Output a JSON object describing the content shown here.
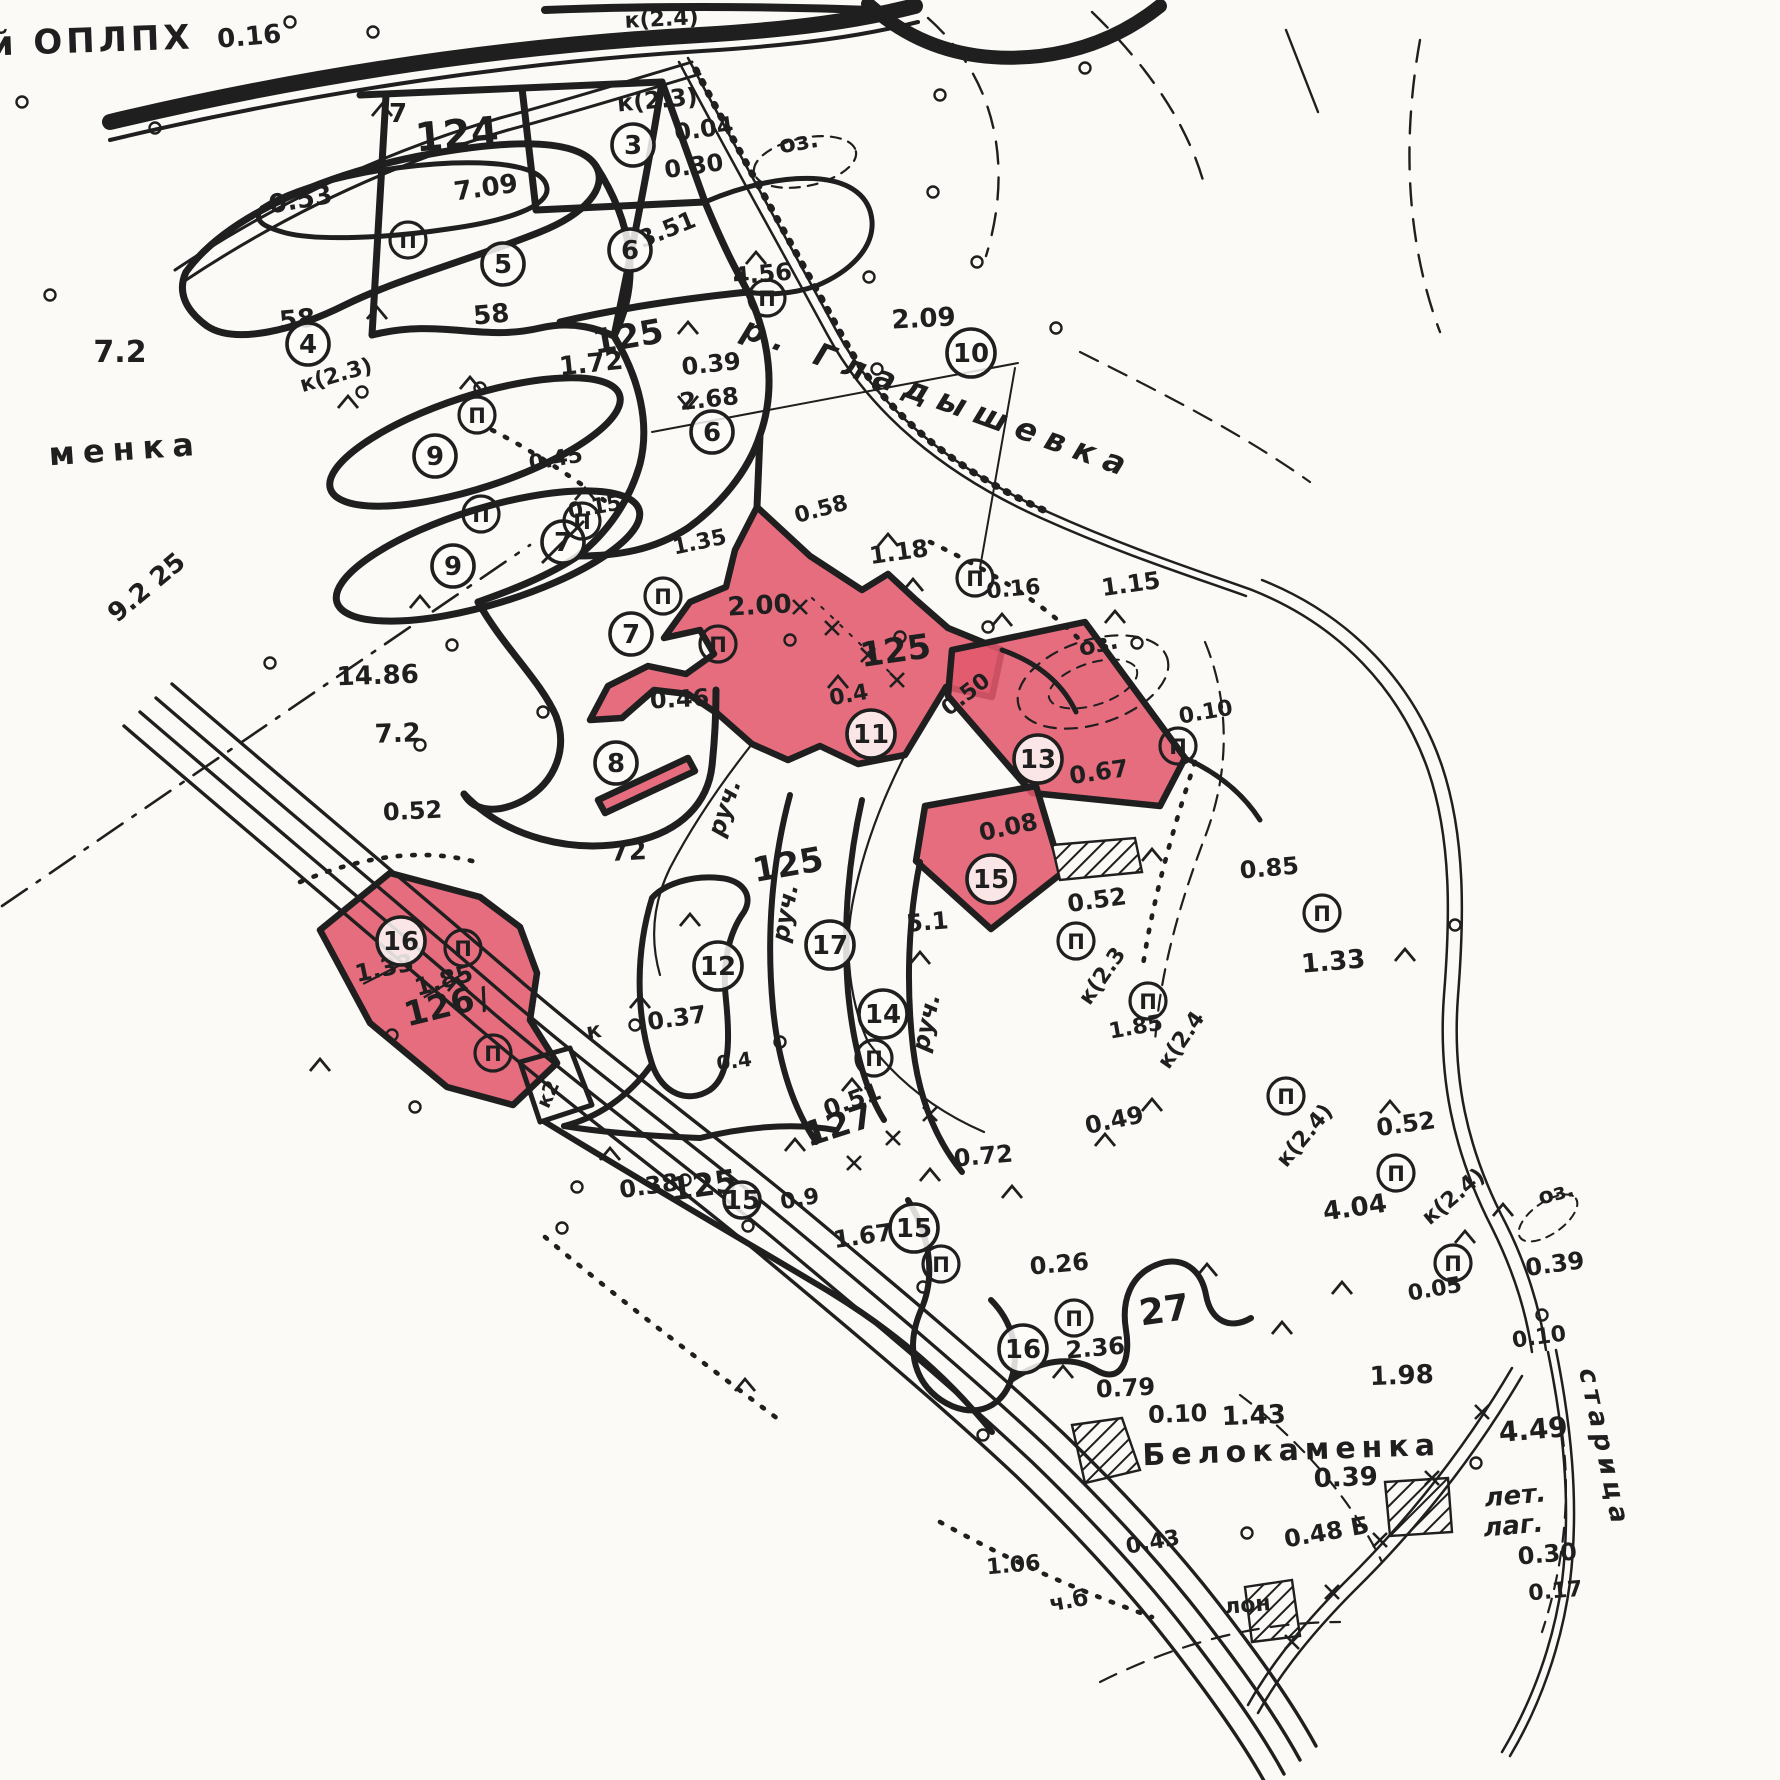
{
  "colors": {
    "paper": "#fbfaf6",
    "ink": "#1f1f1f",
    "highlight": "#e2596d"
  },
  "map": {
    "region_names": [
      "й ОПЛПХ",
      "менка",
      "р. Гладышевка",
      "Белокаменка",
      "старица",
      "лет. лаг."
    ],
    "quarter_numbers": [
      "124",
      "125",
      "126",
      "127"
    ],
    "highlighted_plot_numbers": [
      "11",
      "13",
      "15",
      "16"
    ],
    "labels": [
      {
        "t": "й ОПЛПХ",
        "x": 92,
        "y": 52,
        "s": 34,
        "r": -2,
        "ls": 4
      },
      {
        "t": "0.16",
        "x": 250,
        "y": 45,
        "s": 26,
        "r": -5
      },
      {
        "t": "к(2.4)",
        "x": 662,
        "y": 26,
        "s": 22,
        "r": -3
      },
      {
        "t": "оз.",
        "x": 800,
        "y": 150,
        "s": 24,
        "r": -10
      },
      {
        "t": "менка",
        "x": 126,
        "y": 460,
        "s": 32,
        "r": -4,
        "ls": 8
      },
      {
        "t": "7.2",
        "x": 120,
        "y": 362,
        "s": 30,
        "r": 0
      },
      {
        "t": "9.2 25",
        "x": 152,
        "y": 594,
        "s": 26,
        "r": -40
      },
      {
        "t": "0.53",
        "x": 302,
        "y": 208,
        "s": 26,
        "r": -10
      },
      {
        "t": "124",
        "x": 458,
        "y": 148,
        "s": 40,
        "r": -5
      },
      {
        "t": "7.09",
        "x": 487,
        "y": 196,
        "s": 26,
        "r": -8
      },
      {
        "t": "7",
        "x": 398,
        "y": 122,
        "s": 26,
        "r": 0
      },
      {
        "t": "58",
        "x": 298,
        "y": 328,
        "s": 26,
        "r": -5
      },
      {
        "t": "58",
        "x": 492,
        "y": 323,
        "s": 26,
        "r": -5
      },
      {
        "t": "к(2.3)",
        "x": 338,
        "y": 382,
        "s": 22,
        "r": -16
      },
      {
        "t": "к(2.3)",
        "x": 658,
        "y": 108,
        "s": 24,
        "r": -5
      },
      {
        "t": "0.04",
        "x": 705,
        "y": 137,
        "s": 24,
        "r": -8
      },
      {
        "t": "0.30",
        "x": 695,
        "y": 174,
        "s": 24,
        "r": -8
      },
      {
        "t": "3.51",
        "x": 670,
        "y": 237,
        "s": 24,
        "r": -22
      },
      {
        "t": "4.56",
        "x": 763,
        "y": 282,
        "s": 24,
        "r": -5
      },
      {
        "t": "1.72",
        "x": 592,
        "y": 372,
        "s": 26,
        "r": -6
      },
      {
        "t": "125",
        "x": 630,
        "y": 348,
        "s": 34,
        "r": -10
      },
      {
        "t": "0.39",
        "x": 712,
        "y": 372,
        "s": 24,
        "r": -6
      },
      {
        "t": "2.68",
        "x": 710,
        "y": 407,
        "s": 24,
        "r": -6
      },
      {
        "t": "2.09",
        "x": 924,
        "y": 327,
        "s": 26,
        "r": -3
      },
      {
        "t": "р. Гладышевка",
        "x": 935,
        "y": 408,
        "s": 32,
        "r": 20,
        "ls": 10,
        "i": 1
      },
      {
        "t": "1.18",
        "x": 900,
        "y": 560,
        "s": 24,
        "r": -8
      },
      {
        "t": "0.16",
        "x": 1014,
        "y": 596,
        "s": 22,
        "r": -5
      },
      {
        "t": "1.15",
        "x": 1132,
        "y": 592,
        "s": 24,
        "r": -8
      },
      {
        "t": "оз.",
        "x": 1100,
        "y": 652,
        "s": 24,
        "r": -12
      },
      {
        "t": "2.00",
        "x": 760,
        "y": 614,
        "s": 26,
        "r": -3
      },
      {
        "t": "0.46",
        "x": 680,
        "y": 707,
        "s": 24,
        "r": -3
      },
      {
        "t": "0.45",
        "x": 557,
        "y": 466,
        "s": 22,
        "r": -10
      },
      {
        "t": "0.15",
        "x": 596,
        "y": 514,
        "s": 22,
        "r": -10
      },
      {
        "t": "1.35",
        "x": 701,
        "y": 549,
        "s": 22,
        "r": -12
      },
      {
        "t": "0.58",
        "x": 823,
        "y": 516,
        "s": 22,
        "r": -15
      },
      {
        "t": "14.86",
        "x": 378,
        "y": 684,
        "s": 26,
        "r": -2
      },
      {
        "t": "7.2",
        "x": 398,
        "y": 742,
        "s": 26,
        "r": -2
      },
      {
        "t": "0.52",
        "x": 413,
        "y": 819,
        "s": 24,
        "r": -3
      },
      {
        "t": "72",
        "x": 629,
        "y": 860,
        "s": 26,
        "r": -3
      },
      {
        "t": "0.4",
        "x": 850,
        "y": 702,
        "s": 22,
        "r": -10
      },
      {
        "t": "125",
        "x": 897,
        "y": 662,
        "s": 34,
        "r": -8
      },
      {
        "t": "0.50",
        "x": 970,
        "y": 700,
        "s": 22,
        "r": -38
      },
      {
        "t": "0.67",
        "x": 1100,
        "y": 780,
        "s": 24,
        "r": -8
      },
      {
        "t": "0.08",
        "x": 1010,
        "y": 835,
        "s": 24,
        "r": -12
      },
      {
        "t": "5.1",
        "x": 928,
        "y": 930,
        "s": 24,
        "r": -5
      },
      {
        "t": "0.52",
        "x": 1098,
        "y": 908,
        "s": 24,
        "r": -8
      },
      {
        "t": "к(2.3",
        "x": 1108,
        "y": 980,
        "s": 22,
        "r": -55
      },
      {
        "t": "1.85",
        "x": 1137,
        "y": 1034,
        "s": 22,
        "r": -10
      },
      {
        "t": "к(2.4",
        "x": 1187,
        "y": 1044,
        "s": 22,
        "r": -55
      },
      {
        "t": "0.85",
        "x": 1270,
        "y": 876,
        "s": 24,
        "r": -5
      },
      {
        "t": "1.33",
        "x": 1334,
        "y": 970,
        "s": 26,
        "r": -5
      },
      {
        "t": "0.10",
        "x": 1207,
        "y": 719,
        "s": 22,
        "r": -10
      },
      {
        "t": "125",
        "x": 790,
        "y": 876,
        "s": 34,
        "r": -10
      },
      {
        "t": "0.37",
        "x": 678,
        "y": 1026,
        "s": 24,
        "r": -8
      },
      {
        "t": "руч.",
        "x": 732,
        "y": 810,
        "s": 24,
        "r": -72,
        "i": 1
      },
      {
        "t": "руч.",
        "x": 793,
        "y": 914,
        "s": 24,
        "r": -80,
        "i": 1
      },
      {
        "t": "руч.",
        "x": 934,
        "y": 1024,
        "s": 24,
        "r": -78,
        "i": 1
      },
      {
        "t": "к",
        "x": 595,
        "y": 1038,
        "s": 22,
        "r": -10
      },
      {
        "t": "к2",
        "x": 554,
        "y": 1097,
        "s": 20,
        "r": -65
      },
      {
        "t": "0.51",
        "x": 855,
        "y": 1108,
        "s": 24,
        "r": -20
      },
      {
        "t": "127",
        "x": 842,
        "y": 1136,
        "s": 34,
        "r": -18
      },
      {
        "t": "0.72",
        "x": 984,
        "y": 1164,
        "s": 24,
        "r": -5
      },
      {
        "t": "0.9",
        "x": 801,
        "y": 1206,
        "s": 22,
        "r": -10
      },
      {
        "t": "0.38",
        "x": 650,
        "y": 1194,
        "s": 24,
        "r": -8
      },
      {
        "t": "125",
        "x": 705,
        "y": 1196,
        "s": 32,
        "r": -8
      },
      {
        "t": "1.67",
        "x": 864,
        "y": 1244,
        "s": 24,
        "r": -8
      },
      {
        "t": "0.26",
        "x": 1060,
        "y": 1272,
        "s": 24,
        "r": -5
      },
      {
        "t": "2.36",
        "x": 1096,
        "y": 1356,
        "s": 24,
        "r": -5
      },
      {
        "t": "27",
        "x": 1166,
        "y": 1322,
        "s": 36,
        "r": -8
      },
      {
        "t": "0.49",
        "x": 1116,
        "y": 1128,
        "s": 24,
        "r": -12
      },
      {
        "t": "0.52",
        "x": 1407,
        "y": 1132,
        "s": 24,
        "r": -8
      },
      {
        "t": "4.04",
        "x": 1356,
        "y": 1216,
        "s": 26,
        "r": -8
      },
      {
        "t": "к(2.4)",
        "x": 1310,
        "y": 1140,
        "s": 22,
        "r": -50
      },
      {
        "t": "к(2.4)",
        "x": 1458,
        "y": 1202,
        "s": 22,
        "r": -40
      },
      {
        "t": "0.05",
        "x": 1436,
        "y": 1296,
        "s": 22,
        "r": -10
      },
      {
        "t": "0.39",
        "x": 1556,
        "y": 1272,
        "s": 24,
        "r": -8
      },
      {
        "t": "оз.",
        "x": 1558,
        "y": 1200,
        "s": 22,
        "r": -15
      },
      {
        "t": "0.79",
        "x": 1126,
        "y": 1396,
        "s": 24,
        "r": -3
      },
      {
        "t": "0.10",
        "x": 1178,
        "y": 1422,
        "s": 24,
        "r": -2
      },
      {
        "t": "1.43",
        "x": 1254,
        "y": 1424,
        "s": 26,
        "r": -2
      },
      {
        "t": "1.98",
        "x": 1402,
        "y": 1384,
        "s": 26,
        "r": -2
      },
      {
        "t": "Белокаменка",
        "x": 1292,
        "y": 1460,
        "s": 30,
        "r": -2,
        "ls": 6
      },
      {
        "t": "0.39",
        "x": 1346,
        "y": 1486,
        "s": 26,
        "r": -2
      },
      {
        "t": "4.49",
        "x": 1534,
        "y": 1439,
        "s": 28,
        "r": -5
      },
      {
        "t": "лет.",
        "x": 1516,
        "y": 1504,
        "s": 26,
        "r": -5,
        "i": 1
      },
      {
        "t": "лаг.",
        "x": 1514,
        "y": 1534,
        "s": 26,
        "r": -5,
        "i": 1
      },
      {
        "t": "старица",
        "x": 1596,
        "y": 1450,
        "s": 26,
        "r": 78,
        "ls": 6,
        "i": 1
      },
      {
        "t": "0.10",
        "x": 1540,
        "y": 1344,
        "s": 22,
        "r": -8
      },
      {
        "t": "0.30",
        "x": 1548,
        "y": 1562,
        "s": 24,
        "r": -5
      },
      {
        "t": "0.17",
        "x": 1556,
        "y": 1598,
        "s": 22,
        "r": -5
      },
      {
        "t": "0.48 Б",
        "x": 1328,
        "y": 1540,
        "s": 24,
        "r": -10
      },
      {
        "t": "1.06",
        "x": 1014,
        "y": 1572,
        "s": 22,
        "r": -5
      },
      {
        "t": "0.43",
        "x": 1154,
        "y": 1549,
        "s": 22,
        "r": -10
      },
      {
        "t": "ч.б",
        "x": 1070,
        "y": 1608,
        "s": 22,
        "r": -10
      },
      {
        "t": "лон",
        "x": 1248,
        "y": 1612,
        "s": 22,
        "r": -5
      },
      {
        "t": "1.33",
        "x": 386,
        "y": 976,
        "s": 24,
        "r": -12,
        "st": 1
      },
      {
        "t": "1.85",
        "x": 446,
        "y": 988,
        "s": 24,
        "r": -16,
        "st": 1
      },
      {
        "t": "126",
        "x": 442,
        "y": 1018,
        "s": 34,
        "r": -14
      },
      {
        "t": "/",
        "x": 487,
        "y": 1008,
        "s": 30,
        "r": -20
      },
      {
        "t": "0.4",
        "x": 735,
        "y": 1068,
        "s": 20,
        "r": -8
      }
    ],
    "plot_markers": [
      {
        "n": "3",
        "x": 633,
        "y": 145
      },
      {
        "n": "4",
        "x": 308,
        "y": 344
      },
      {
        "n": "5",
        "x": 503,
        "y": 264
      },
      {
        "n": "6",
        "x": 630,
        "y": 250
      },
      {
        "n": "6",
        "x": 712,
        "y": 432
      },
      {
        "n": "10",
        "x": 971,
        "y": 353
      },
      {
        "n": "9",
        "x": 435,
        "y": 456
      },
      {
        "n": "9",
        "x": 453,
        "y": 566
      },
      {
        "n": "7",
        "x": 563,
        "y": 542,
        "struck": 1
      },
      {
        "n": "7",
        "x": 631,
        "y": 634
      },
      {
        "n": "8",
        "x": 616,
        "y": 763
      },
      {
        "n": "11",
        "x": 871,
        "y": 734
      },
      {
        "n": "13",
        "x": 1038,
        "y": 759
      },
      {
        "n": "15",
        "x": 991,
        "y": 879
      },
      {
        "n": "12",
        "x": 718,
        "y": 966
      },
      {
        "n": "17",
        "x": 830,
        "y": 945
      },
      {
        "n": "14",
        "x": 883,
        "y": 1014
      },
      {
        "n": "16",
        "x": 401,
        "y": 941
      },
      {
        "n": "15",
        "x": 914,
        "y": 1228
      },
      {
        "n": "15",
        "x": 742,
        "y": 1200,
        "r": 18
      },
      {
        "n": "16",
        "x": 1023,
        "y": 1349
      }
    ],
    "p_markers": [
      [
        408,
        240
      ],
      [
        477,
        415
      ],
      [
        481,
        514
      ],
      [
        582,
        521
      ],
      [
        663,
        596
      ],
      [
        718,
        644
      ],
      [
        767,
        298
      ],
      [
        975,
        578
      ],
      [
        1178,
        746
      ],
      [
        1322,
        913
      ],
      [
        1148,
        1001
      ],
      [
        1076,
        941
      ],
      [
        874,
        1058
      ],
      [
        941,
        1264
      ],
      [
        1074,
        1318
      ],
      [
        1286,
        1096
      ],
      [
        1396,
        1173
      ],
      [
        1453,
        1263
      ],
      [
        463,
        948
      ],
      [
        493,
        1053
      ]
    ],
    "symbols": {
      "rings": [
        [
          22,
          102
        ],
        [
          50,
          295
        ],
        [
          155,
          128
        ],
        [
          290,
          22
        ],
        [
          373,
          32
        ],
        [
          480,
          388
        ],
        [
          362,
          392
        ],
        [
          452,
          645
        ],
        [
          270,
          663
        ],
        [
          420,
          745
        ],
        [
          543,
          712
        ],
        [
          869,
          277
        ],
        [
          933,
          192
        ],
        [
          977,
          262
        ],
        [
          1056,
          328
        ],
        [
          1085,
          68
        ],
        [
          940,
          95
        ],
        [
          877,
          369
        ],
        [
          1137,
          643
        ],
        [
          790,
          640
        ],
        [
          900,
          637
        ],
        [
          988,
          627
        ],
        [
          392,
          1035
        ],
        [
          415,
          1107
        ],
        [
          562,
          1228
        ],
        [
          577,
          1187
        ],
        [
          635,
          1025
        ],
        [
          780,
          1042
        ],
        [
          923,
          1287
        ],
        [
          983,
          1435
        ],
        [
          1455,
          925
        ],
        [
          1476,
          1463
        ],
        [
          1247,
          1533
        ],
        [
          1542,
          1315
        ],
        [
          685,
          1180
        ],
        [
          748,
          1226
        ]
      ],
      "carets": [
        [
          382,
          110
        ],
        [
          377,
          313
        ],
        [
          348,
          402
        ],
        [
          470,
          383
        ],
        [
          420,
          602
        ],
        [
          585,
          494
        ],
        [
          688,
          328
        ],
        [
          756,
          258
        ],
        [
          888,
          540
        ],
        [
          913,
          585
        ],
        [
          1002,
          620
        ],
        [
          1115,
          617
        ],
        [
          838,
          682
        ],
        [
          920,
          958
        ],
        [
          852,
          1085
        ],
        [
          610,
          1154
        ],
        [
          1012,
          1192
        ],
        [
          1063,
          1372
        ],
        [
          1390,
          1107
        ],
        [
          1282,
          1328
        ],
        [
          1465,
          1237
        ],
        [
          1503,
          1210
        ],
        [
          1207,
          1270
        ],
        [
          795,
          1145
        ],
        [
          930,
          1175
        ],
        [
          1105,
          1140
        ],
        [
          745,
          1385
        ],
        [
          690,
          920
        ],
        [
          640,
          1002
        ],
        [
          320,
          1065
        ],
        [
          458,
          985
        ],
        [
          1405,
          955
        ],
        [
          1152,
          1105
        ],
        [
          1152,
          855
        ],
        [
          688,
          402,
          180
        ],
        [
          1342,
          1288
        ]
      ],
      "crosses": [
        [
          800,
          607
        ],
        [
          832,
          628
        ],
        [
          868,
          655
        ],
        [
          897,
          680
        ],
        [
          854,
          1163
        ],
        [
          893,
          1138
        ],
        [
          930,
          1114
        ],
        [
          1482,
          1412
        ],
        [
          1432,
          1478
        ],
        [
          1380,
          1540
        ],
        [
          1332,
          1592
        ],
        [
          1292,
          1642
        ]
      ]
    }
  }
}
